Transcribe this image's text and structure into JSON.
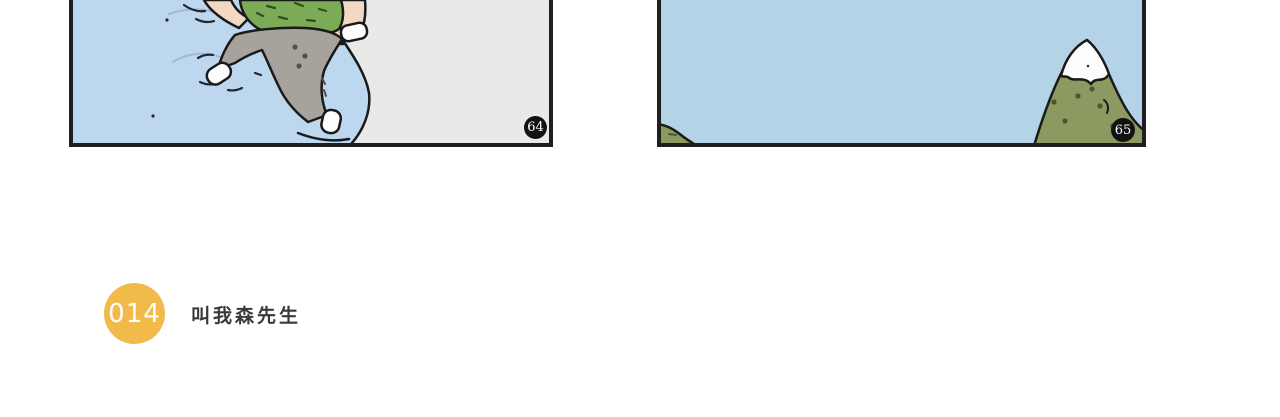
{
  "page": {
    "background_color": "#ffffff"
  },
  "comic": {
    "panels": [
      {
        "number": "64",
        "scene": "rear view of a person in a green shirt and gray pants climbing a snowy blue slope",
        "colors": {
          "ice_blue": "#bdd7ee",
          "slope_gray": "#e9e9e7",
          "shirt_green": "#7cab57",
          "pants_gray": "#a8a29c",
          "skin": "#f3d9c4",
          "shoes": "#fdfdfd",
          "outline": "#1a1a1a"
        }
      },
      {
        "number": "65",
        "scene": "pale blue sky with a small green hill at lower left and a snow-capped green mountain at right",
        "colors": {
          "sky_blue": "#b5d3e7",
          "mountain_green": "#8a9a60",
          "snow_white": "#fdfdfd",
          "outline": "#1a1a1a"
        }
      }
    ],
    "panel_badge": {
      "background": "#121212",
      "text_color": "#ffffff"
    }
  },
  "chapter": {
    "number": "014",
    "title": "叫我森先生",
    "badge_color": "#f2b94b",
    "number_color": "#ffffff",
    "title_color": "#3a3a3a"
  }
}
